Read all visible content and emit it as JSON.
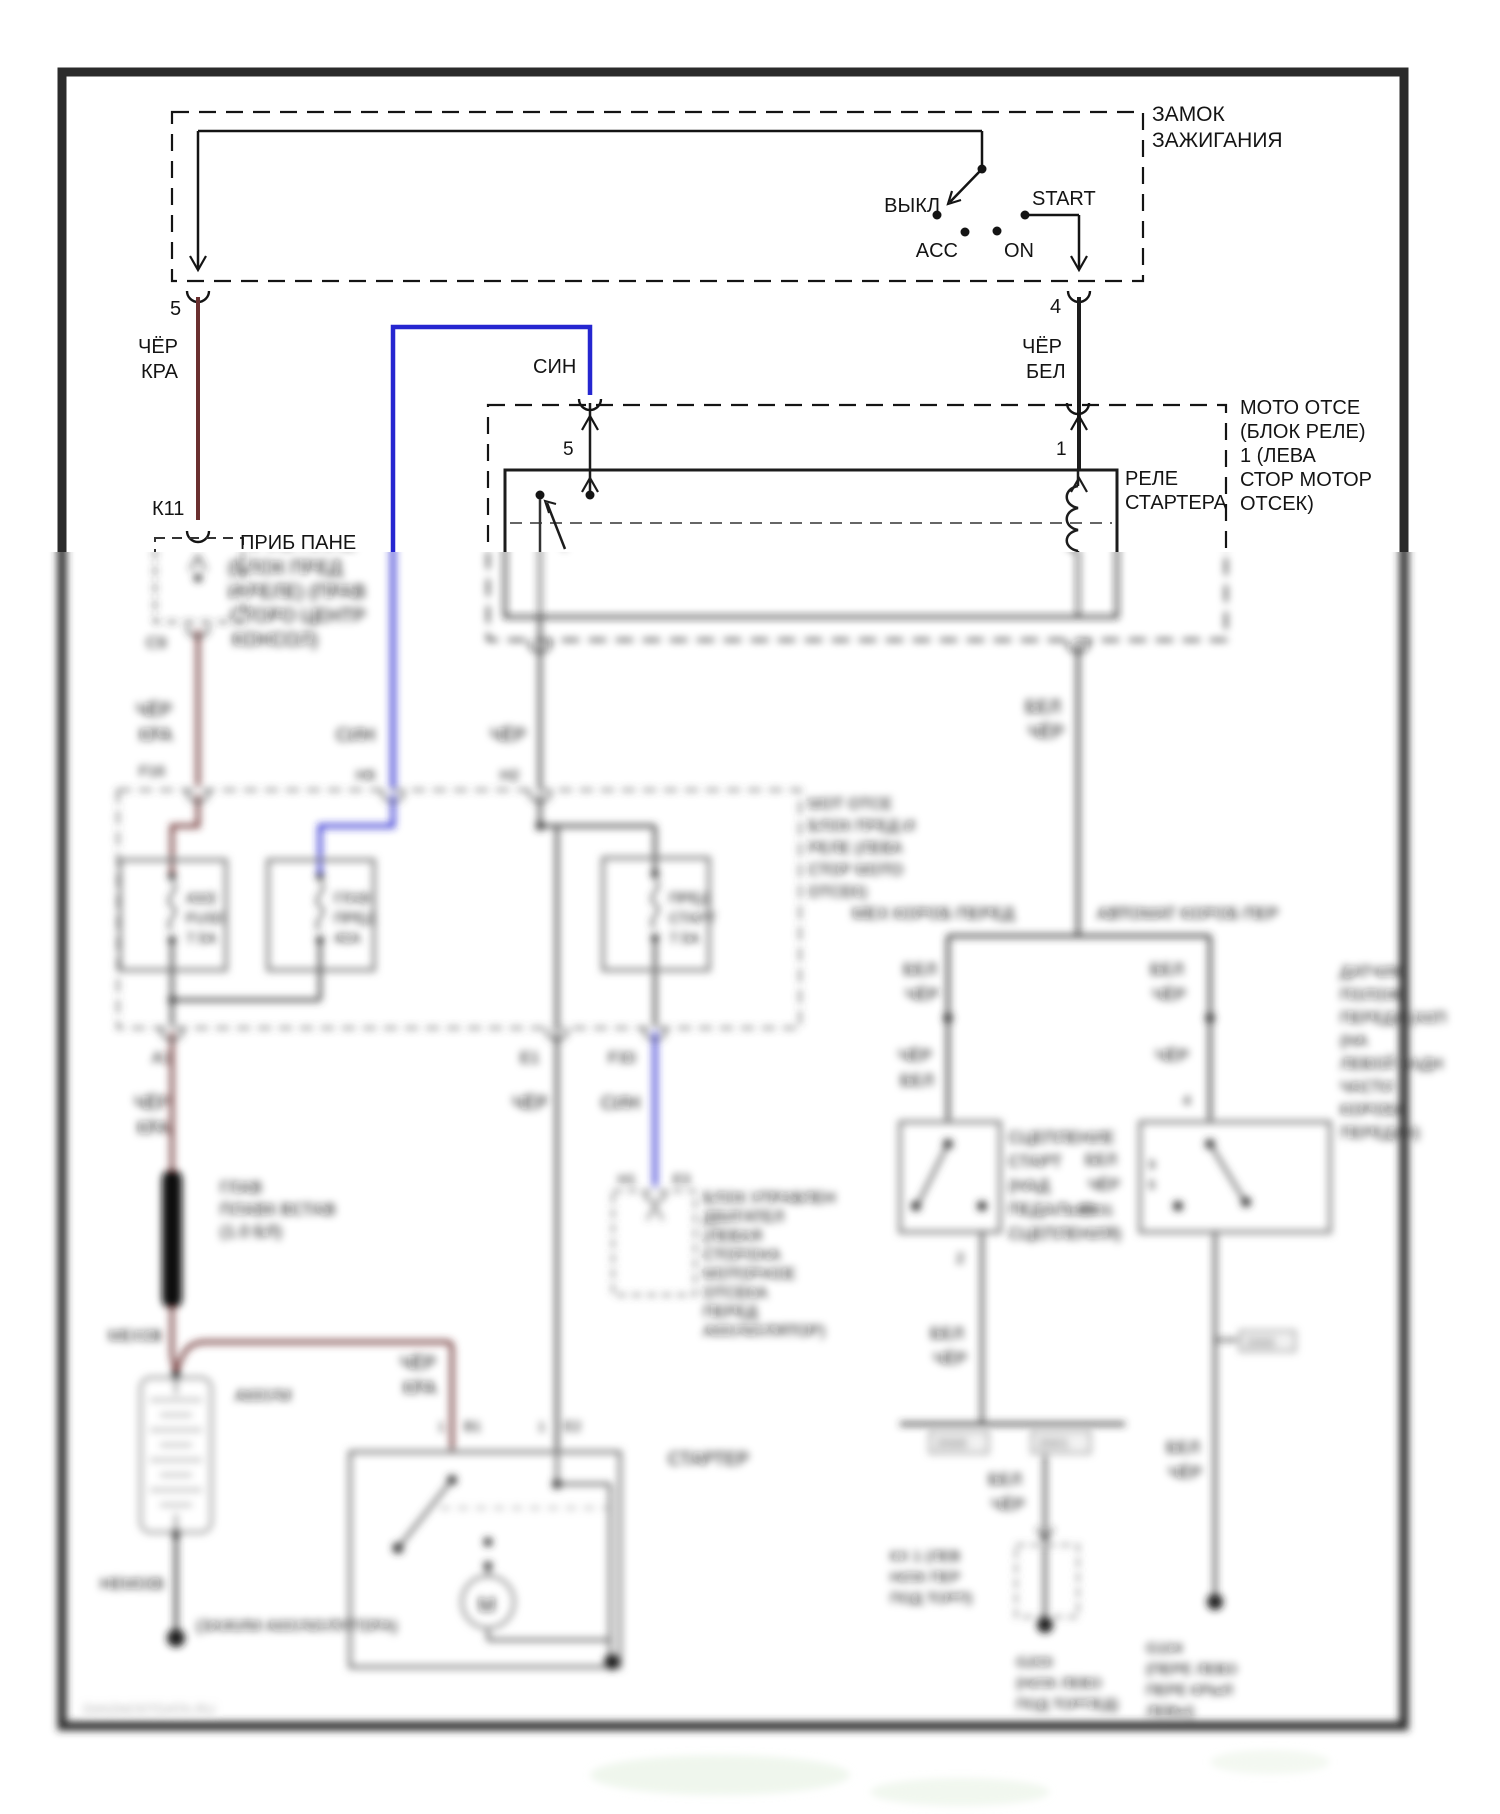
{
  "document": {
    "type": "automotive-wiring-diagram",
    "language": "ru",
    "subject": "starter / ignition circuit",
    "watermark": "DIAGNOSTDATA.RU"
  },
  "colors": {
    "wire_red": "#6b2f2f",
    "wire_blue": "#2526d0",
    "wire_black": "#1c1c1c",
    "wire_gray": "#3f3f3f",
    "box_gray": "#6f6f6f",
    "border": "#2b2b2b",
    "text": "#141414",
    "watermark": "#b0b0b0",
    "background": "#ffffff"
  },
  "texts": [
    {
      "n": "ignition-title-line1",
      "t": "ЗАМОК",
      "x": 1152,
      "y": 121,
      "s": 21
    },
    {
      "n": "ignition-title-line2",
      "t": "ЗАЖИГАНИЯ",
      "x": 1152,
      "y": 147,
      "s": 21
    },
    {
      "n": "position-off",
      "t": "ВЫКЛ",
      "x": 940,
      "y": 212,
      "s": 20,
      "a": "end"
    },
    {
      "n": "position-acc",
      "t": "ACC",
      "x": 958,
      "y": 257,
      "s": 20,
      "a": "end"
    },
    {
      "n": "position-on",
      "t": "ON",
      "x": 1004,
      "y": 257,
      "s": 20
    },
    {
      "n": "position-start",
      "t": "START",
      "x": 1032,
      "y": 205,
      "s": 20
    },
    {
      "n": "pin-4",
      "t": "4",
      "x": 1050,
      "y": 313,
      "s": 20
    },
    {
      "n": "pin-5",
      "t": "5",
      "x": 170,
      "y": 315,
      "s": 20
    },
    {
      "n": "wire5-color-line1",
      "t": "ЧЁР",
      "x": 138,
      "y": 353,
      "s": 20
    },
    {
      "n": "wire5-color-line2",
      "t": "КРА",
      "x": 141,
      "y": 378,
      "s": 20
    },
    {
      "n": "wire4-color-line1",
      "t": "ЧЁР",
      "x": 1022,
      "y": 353,
      "s": 20
    },
    {
      "n": "wire4-color-line2",
      "t": "БЕЛ",
      "x": 1026,
      "y": 378,
      "s": 20
    },
    {
      "n": "blue-wire-label",
      "t": "СИН",
      "x": 533,
      "y": 373,
      "s": 20
    },
    {
      "n": "connector-k11",
      "t": "К11",
      "x": 152,
      "y": 515,
      "s": 20
    },
    {
      "n": "moto-line1",
      "t": "МОТО ОТСЕ",
      "x": 1240,
      "y": 414,
      "s": 20
    },
    {
      "n": "moto-line2",
      "t": "(БЛОК РЕЛЕ)",
      "x": 1240,
      "y": 438,
      "s": 20
    },
    {
      "n": "moto-line3",
      "t": "1 (ЛЕВА",
      "x": 1240,
      "y": 462,
      "s": 20
    },
    {
      "n": "moto-line4",
      "t": "СТОР МОТОР",
      "x": 1240,
      "y": 486,
      "s": 20
    },
    {
      "n": "moto-line5",
      "t": "ОТСЕК)",
      "x": 1240,
      "y": 510,
      "s": 20
    },
    {
      "n": "moto-pin-5",
      "t": "5",
      "x": 563,
      "y": 455,
      "s": 19
    },
    {
      "n": "moto-pin-1",
      "t": "1",
      "x": 1056,
      "y": 455,
      "s": 19
    },
    {
      "n": "relay-label-line1",
      "t": "РЕЛЕ",
      "x": 1125,
      "y": 485,
      "s": 20
    },
    {
      "n": "relay-label-line2",
      "t": "СТАРТЕРА",
      "x": 1125,
      "y": 509,
      "s": 20
    },
    {
      "n": "prib-line1",
      "t": "ПРИБ ПАНЕ",
      "x": 240,
      "y": 549,
      "s": 20
    },
    {
      "n": "prib-line2",
      "t": "(БЛОК ПРЕД",
      "x": 228,
      "y": 574,
      "s": 19
    },
    {
      "n": "prib-line3",
      "t": "И РЕЛЕ) (ПРАВ",
      "x": 228,
      "y": 598,
      "s": 19
    },
    {
      "n": "prib-line4",
      "t": "СТОРО ЦЕНТР",
      "x": 230,
      "y": 622,
      "s": 19
    },
    {
      "n": "prib-line5",
      "t": "КОНСОЛ)",
      "x": 232,
      "y": 646,
      "s": 19
    },
    {
      "n": "connector-c9",
      "t": "С9",
      "x": 146,
      "y": 648,
      "s": 16
    },
    {
      "n": "wire-red-mid-line1",
      "t": "ЧЁР",
      "x": 136,
      "y": 716,
      "s": 18
    },
    {
      "n": "wire-red-mid-line2",
      "t": "КРА",
      "x": 139,
      "y": 741,
      "s": 18
    },
    {
      "n": "pin-f16",
      "t": "F16",
      "x": 139,
      "y": 776,
      "s": 15
    },
    {
      "n": "wire-blue-mid-label",
      "t": "СИН",
      "x": 336,
      "y": 741,
      "s": 18
    },
    {
      "n": "pin-h6",
      "t": "Н6",
      "x": 356,
      "y": 780,
      "s": 15
    },
    {
      "n": "wire-gray-mid-label",
      "t": "ЧЁР",
      "x": 490,
      "y": 741,
      "s": 18
    },
    {
      "n": "pin-h2",
      "t": "Н2",
      "x": 500,
      "y": 780,
      "s": 15
    },
    {
      "n": "fusebox-note-line1",
      "t": "МОТ ОТСЕ",
      "x": 808,
      "y": 809,
      "s": 16
    },
    {
      "n": "fusebox-note-line2",
      "t": "БЛОК ПРЕД И",
      "x": 808,
      "y": 831,
      "s": 16
    },
    {
      "n": "fusebox-note-line3",
      "t": "РЕЛЕ (ЛЕВА",
      "x": 808,
      "y": 853,
      "s": 16
    },
    {
      "n": "fusebox-note-line4",
      "t": "СТОР МОТО",
      "x": 808,
      "y": 875,
      "s": 16
    },
    {
      "n": "fusebox-note-line5",
      "t": "ОТСЕК)",
      "x": 808,
      "y": 897,
      "s": 16
    },
    {
      "n": "fuse1-line1",
      "t": "АМ2",
      "x": 186,
      "y": 903,
      "s": 15
    },
    {
      "n": "fuse1-line2",
      "t": "FUSE",
      "x": 186,
      "y": 923,
      "s": 15
    },
    {
      "n": "fuse1-line3",
      "t": "7.5А",
      "x": 186,
      "y": 943,
      "s": 15
    },
    {
      "n": "fuse2-line1",
      "t": "ГЛАВ",
      "x": 334,
      "y": 903,
      "s": 15
    },
    {
      "n": "fuse2-line2",
      "t": "ПРЕД",
      "x": 334,
      "y": 923,
      "s": 15
    },
    {
      "n": "fuse2-line3",
      "t": "40А",
      "x": 334,
      "y": 943,
      "s": 15
    },
    {
      "n": "fuse3-line1",
      "t": "ПРЕД",
      "x": 669,
      "y": 903,
      "s": 15
    },
    {
      "n": "fuse3-line2",
      "t": "СТАРТ",
      "x": 669,
      "y": 923,
      "s": 15
    },
    {
      "n": "fuse3-line3",
      "t": "7.5А",
      "x": 669,
      "y": 943,
      "s": 15
    },
    {
      "n": "label-manual-trans",
      "t": "МЕХ КОРОБ ПЕРЕД",
      "x": 852,
      "y": 919,
      "s": 17
    },
    {
      "n": "label-auto-trans",
      "t": "АВТОМАТ КОРОБ ПЕР",
      "x": 1097,
      "y": 919,
      "s": 17
    },
    {
      "n": "pin-a1",
      "t": "А1",
      "x": 152,
      "y": 1063,
      "s": 16
    },
    {
      "n": "wire-red-low-line1",
      "t": "ЧЁР",
      "x": 134,
      "y": 1109,
      "s": 18
    },
    {
      "n": "wire-red-low-line2",
      "t": "КРА",
      "x": 137,
      "y": 1134,
      "s": 18
    },
    {
      "n": "pin-e1",
      "t": "Е1",
      "x": 520,
      "y": 1063,
      "s": 16
    },
    {
      "n": "wire-gray-low-label",
      "t": "ЧЁР",
      "x": 512,
      "y": 1109,
      "s": 18
    },
    {
      "n": "pin-f30",
      "t": "F30",
      "x": 608,
      "y": 1063,
      "s": 16
    },
    {
      "n": "wire-blue-low-label",
      "t": "СИН",
      "x": 601,
      "y": 1109,
      "s": 18
    },
    {
      "n": "pin-h1",
      "t": "Н1",
      "x": 618,
      "y": 1184,
      "s": 14
    },
    {
      "n": "pin-e3",
      "t": "Е3",
      "x": 673,
      "y": 1184,
      "s": 14
    },
    {
      "n": "ecm-line1",
      "t": "БЛОК УПРАВЛЕН",
      "x": 703,
      "y": 1203,
      "s": 16
    },
    {
      "n": "ecm-line2",
      "t": "ДВИГАТЕЛ",
      "x": 703,
      "y": 1222,
      "s": 16
    },
    {
      "n": "ecm-line3",
      "t": "(ЛЕВАЯ",
      "x": 703,
      "y": 1241,
      "s": 16
    },
    {
      "n": "ecm-line4",
      "t": "СТОРОНА",
      "x": 703,
      "y": 1260,
      "s": 16
    },
    {
      "n": "ecm-line5",
      "t": "МОТОРНОЕ",
      "x": 703,
      "y": 1279,
      "s": 16
    },
    {
      "n": "ecm-line6",
      "t": "ОТСЕКА",
      "x": 703,
      "y": 1298,
      "s": 16
    },
    {
      "n": "ecm-line7",
      "t": "ПЕРЕД",
      "x": 703,
      "y": 1317,
      "s": 16
    },
    {
      "n": "ecm-line8",
      "t": "АККУМУЛЯТОР)",
      "x": 703,
      "y": 1336,
      "s": 16
    },
    {
      "n": "fusible-link-line1",
      "t": "ГЛАВ",
      "x": 220,
      "y": 1193,
      "s": 17
    },
    {
      "n": "fusible-link-line2",
      "t": "ПЛАВК ВСТАВ",
      "x": 220,
      "y": 1215,
      "s": 17
    },
    {
      "n": "fusible-link-line3",
      "t": "(1.0 БЛ)",
      "x": 220,
      "y": 1237,
      "s": 17
    },
    {
      "n": "connector-meh0v",
      "t": "МЕХ0В",
      "x": 108,
      "y": 1341,
      "s": 16
    },
    {
      "n": "wire-red-branch-line1",
      "t": "ЧЁР",
      "x": 400,
      "y": 1369,
      "s": 18
    },
    {
      "n": "wire-red-branch-line2",
      "t": "КРА",
      "x": 403,
      "y": 1394,
      "s": 18
    },
    {
      "n": "battery-label",
      "t": "АККУМ",
      "x": 235,
      "y": 1401,
      "s": 17
    },
    {
      "n": "starter-pin1a",
      "t": "1",
      "x": 438,
      "y": 1431,
      "s": 13
    },
    {
      "n": "starter-pin-b1",
      "t": "В1",
      "x": 464,
      "y": 1431,
      "s": 14
    },
    {
      "n": "starter-pin1b",
      "t": "1",
      "x": 538,
      "y": 1431,
      "s": 13
    },
    {
      "n": "starter-pin-e2",
      "t": "Е2",
      "x": 564,
      "y": 1431,
      "s": 14
    },
    {
      "n": "starter-label",
      "t": "СТАРТЕР",
      "x": 668,
      "y": 1465,
      "s": 18
    },
    {
      "n": "connector-nem03v",
      "t": "НЕМ03В",
      "x": 100,
      "y": 1589,
      "s": 16
    },
    {
      "n": "battery-clamp-label",
      "t": "(ЗАЖИМ АККУМУЛЯТОРА)",
      "x": 196,
      "y": 1631,
      "s": 16
    },
    {
      "n": "wire-right-line1",
      "t": "БЕЛ",
      "x": 1025,
      "y": 713,
      "s": 18
    },
    {
      "n": "wire-right-line2",
      "t": "ЧЁР",
      "x": 1028,
      "y": 738,
      "s": 18
    },
    {
      "n": "wire-mt-line1",
      "t": "БЕЛ",
      "x": 903,
      "y": 975,
      "s": 17
    },
    {
      "n": "wire-mt-line2",
      "t": "ЧЁР",
      "x": 905,
      "y": 1000,
      "s": 17
    },
    {
      "n": "wire-mt2-line1",
      "t": "ЧЁР",
      "x": 898,
      "y": 1061,
      "s": 17
    },
    {
      "n": "wire-mt2-line2",
      "t": "БЕЛ",
      "x": 900,
      "y": 1086,
      "s": 17
    },
    {
      "n": "wire-at-line1",
      "t": "БЕЛ",
      "x": 1150,
      "y": 975,
      "s": 17
    },
    {
      "n": "wire-at-line2",
      "t": "ЧЁР",
      "x": 1152,
      "y": 1000,
      "s": 17
    },
    {
      "n": "wire-at2-label",
      "t": "ЧЁР",
      "x": 1155,
      "y": 1061,
      "s": 17
    },
    {
      "n": "pin-4b",
      "t": "4",
      "x": 1183,
      "y": 1105,
      "s": 14
    },
    {
      "n": "clutch-line1",
      "t": "СЦЕПЛЕНИЕ",
      "x": 1008,
      "y": 1143,
      "s": 17
    },
    {
      "n": "clutch-line2",
      "t": "СТАРТ",
      "x": 1008,
      "y": 1167,
      "s": 17
    },
    {
      "n": "clutch-line3",
      "t": "(НАД",
      "x": 1008,
      "y": 1191,
      "s": 17
    },
    {
      "n": "clutch-line4",
      "t": "ПЕДАЛЬЮ",
      "x": 1008,
      "y": 1215,
      "s": 17
    },
    {
      "n": "clutch-line5",
      "t": "СЦЕПЛЕНИЯ)",
      "x": 1008,
      "y": 1239,
      "s": 17
    },
    {
      "n": "sensor-line1",
      "t": "ДАТЧИК",
      "x": 1340,
      "y": 977,
      "s": 16
    },
    {
      "n": "sensor-line2",
      "t": "ПОЛОЖ",
      "x": 1340,
      "y": 1000,
      "s": 16
    },
    {
      "n": "sensor-line3",
      "t": "ПЕРЕДА (АКП",
      "x": 1340,
      "y": 1023,
      "s": 16
    },
    {
      "n": "sensor-line4",
      "t": "(НА",
      "x": 1340,
      "y": 1046,
      "s": 16
    },
    {
      "n": "sensor-line5",
      "t": "ЛЕВОЙ ЗАДН",
      "x": 1340,
      "y": 1069,
      "s": 16
    },
    {
      "n": "sensor-line6",
      "t": "ЧАСТИ",
      "x": 1340,
      "y": 1092,
      "s": 16
    },
    {
      "n": "sensor-line7",
      "t": "КОРОБК",
      "x": 1340,
      "y": 1115,
      "s": 16
    },
    {
      "n": "sensor-line8",
      "t": "ПЕРЕДАЧ)",
      "x": 1340,
      "y": 1138,
      "s": 16
    },
    {
      "n": "sensor-pin9",
      "t": "9",
      "x": 1148,
      "y": 1169,
      "s": 13
    },
    {
      "n": "sensor-pin6",
      "t": "6",
      "x": 1148,
      "y": 1189,
      "s": 13
    },
    {
      "n": "clutch-pin2",
      "t": "2",
      "x": 956,
      "y": 1263,
      "s": 15
    },
    {
      "n": "wire-mt3-line1",
      "t": "БЕЛ",
      "x": 930,
      "y": 1339,
      "s": 17
    },
    {
      "n": "wire-mt3-line2",
      "t": "ЧЁР",
      "x": 933,
      "y": 1364,
      "s": 17
    },
    {
      "n": "wire-at3-line1",
      "t": "БЕЛ",
      "x": 1085,
      "y": 1165,
      "s": 16
    },
    {
      "n": "wire-at3-line2",
      "t": "ЧЁР",
      "x": 1088,
      "y": 1190,
      "s": 16
    },
    {
      "n": "connector-2001a",
      "t": "2001",
      "x": 1080,
      "y": 1215,
      "s": 15
    },
    {
      "n": "tab-2000",
      "t": "2000",
      "x": 936,
      "y": 1448,
      "s": 14
    },
    {
      "n": "tab-2001",
      "t": "2001",
      "x": 1038,
      "y": 1448,
      "s": 14
    },
    {
      "n": "tab-2000b",
      "t": "2000",
      "x": 1246,
      "y": 1347,
      "s": 13
    },
    {
      "n": "wire-gnd1-line1",
      "t": "БЕЛ",
      "x": 988,
      "y": 1485,
      "s": 17
    },
    {
      "n": "wire-gnd1-line2",
      "t": "ЧЁР",
      "x": 991,
      "y": 1510,
      "s": 17
    },
    {
      "n": "kx1-line1",
      "t": "КХ 1 (ЛЕВ",
      "x": 890,
      "y": 1561,
      "s": 15
    },
    {
      "n": "kx1-line2",
      "t": "НИЖ ПЕР",
      "x": 890,
      "y": 1582,
      "s": 15
    },
    {
      "n": "kx1-line3",
      "t": "ПОД ТОРП)",
      "x": 890,
      "y": 1603,
      "s": 15
    },
    {
      "n": "g200-line1",
      "t": "G200",
      "x": 1016,
      "y": 1667,
      "s": 15
    },
    {
      "n": "g200-line2",
      "t": "(НИЖ ЛЕВО",
      "x": 1016,
      "y": 1688,
      "s": 15
    },
    {
      "n": "g200-line3",
      "t": "ПОД ТОРПЕД)",
      "x": 1016,
      "y": 1709,
      "s": 15
    },
    {
      "n": "wire-gnd2-line1",
      "t": "БЕЛ",
      "x": 1166,
      "y": 1453,
      "s": 17
    },
    {
      "n": "wire-gnd2-line2",
      "t": "ЧЁР",
      "x": 1168,
      "y": 1478,
      "s": 17
    },
    {
      "n": "g104-line1",
      "t": "G104",
      "x": 1146,
      "y": 1653,
      "s": 15
    },
    {
      "n": "g104-line2",
      "t": "(ПЕРЕ ЛЕВО",
      "x": 1146,
      "y": 1674,
      "s": 15
    },
    {
      "n": "g104-line3",
      "t": "ПЕРЕ КРЫЛ",
      "x": 1146,
      "y": 1695,
      "s": 15
    },
    {
      "n": "g104-line4",
      "t": "ЛЕВЫ)",
      "x": 1146,
      "y": 1716,
      "s": 15
    },
    {
      "n": "motor-m",
      "t": "М",
      "x": 478,
      "y": 1612,
      "s": 21
    },
    {
      "n": "watermark",
      "t": "DIAGNOSTDATA.RU",
      "x": 83,
      "y": 1714,
      "s": 14,
      "c": "#b0b0b0"
    }
  ]
}
